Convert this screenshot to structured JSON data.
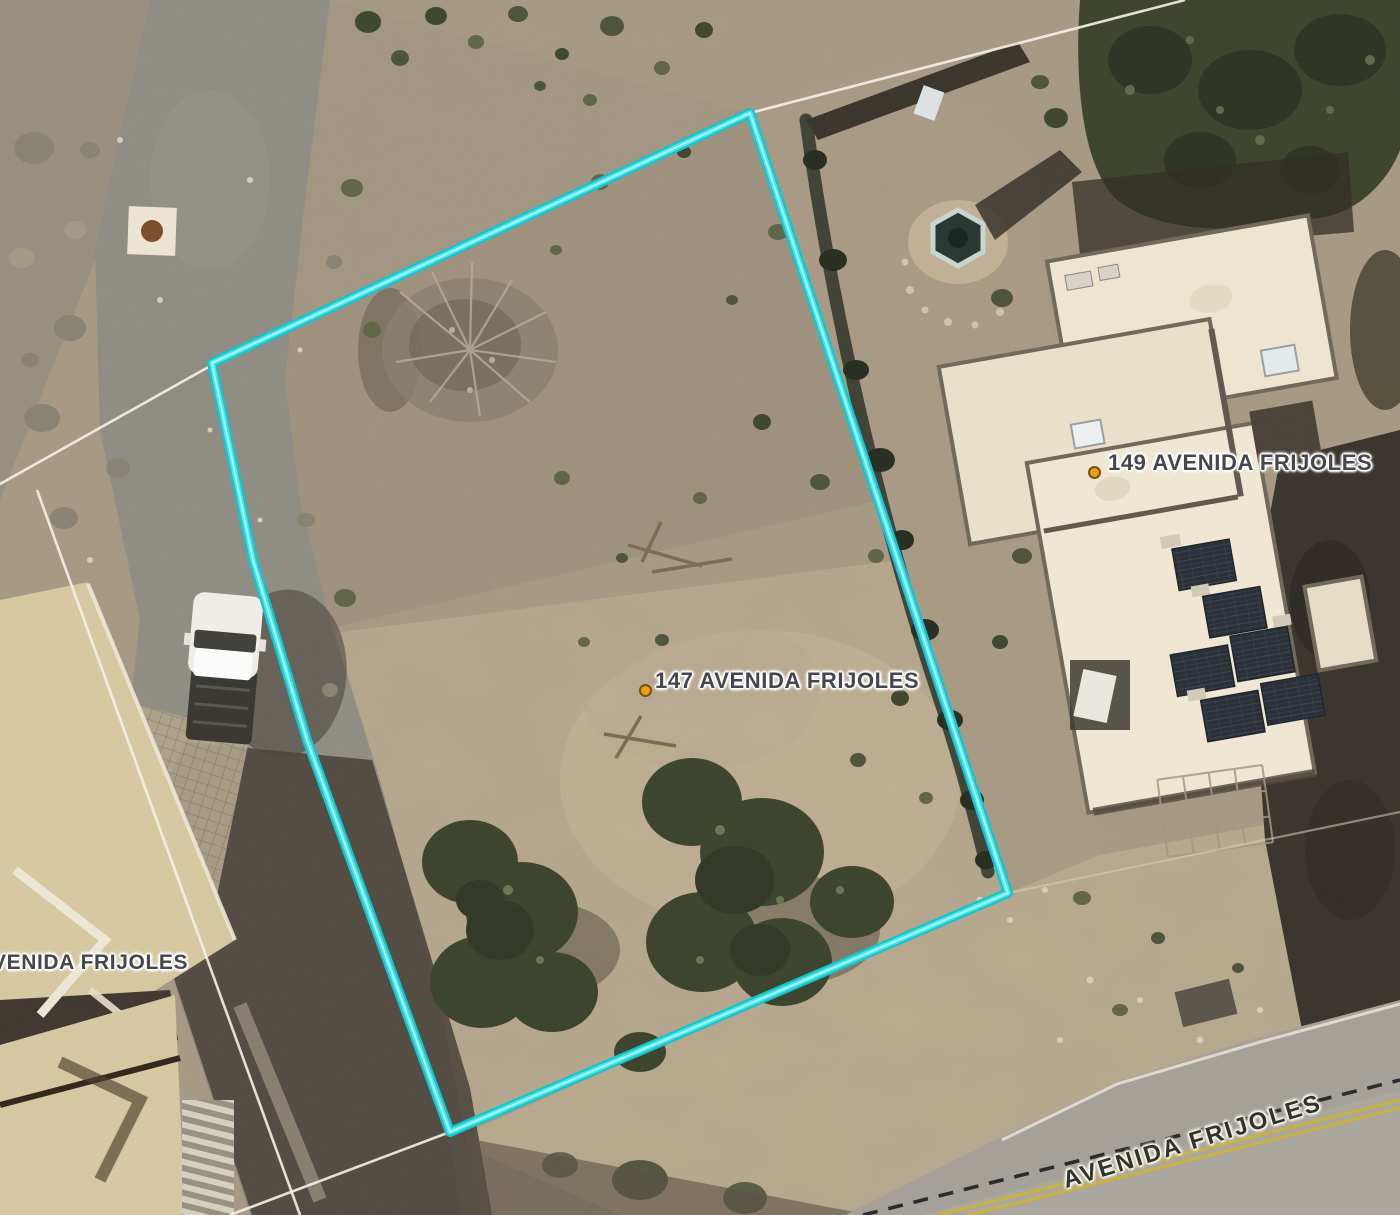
{
  "map": {
    "kind": "aerial-parcel-imagery",
    "subject_parcel": {
      "label": "147 AVENIDA FRIJOLES",
      "boundary_color": "#35dde5"
    },
    "labels": {
      "parcel_147": "147 AVENIDA FRIJOLES",
      "parcel_149": "149 AVENIDA FRIJOLES",
      "parcel_left_partial": "VENIDA FRIJOLES",
      "street": "AVENIDA FRIJOLES"
    },
    "colors": {
      "boundary_cyan": "#35dde5",
      "boundary_cyan_core": "#a9f8fa",
      "parcel_line_white": "#f4f1e8",
      "parcel_line_dashed": "#17171c",
      "road_centerline_yellow": "#c9b33f",
      "marker_orange": "#f29d16",
      "label_text": "#45464e",
      "roof_cream": "#f0e8d3",
      "solar_panel_dark": "#252b34",
      "terrain_tan": "#a89a84"
    },
    "icons": {
      "parcel_marker": "orange-dot-icon"
    }
  }
}
